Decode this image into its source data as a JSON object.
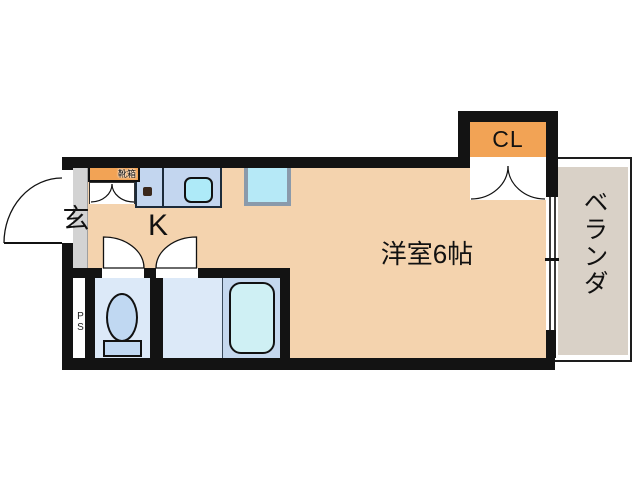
{
  "plan": {
    "rooms": {
      "entrance_label": "玄",
      "kitchen_label": "K",
      "western_room_label": "洋室6帖",
      "closet_label": "CL",
      "veranda_label": "ベランダ",
      "pipe_space_label": "PS",
      "shoe_box_label": "靴箱"
    },
    "colors": {
      "wall": "#131313",
      "room_floor": "#f4d3ae",
      "accent_orange": "#f2a355",
      "entrance_floor": "#d3d3d3",
      "veranda_floor": "#d9d1c7",
      "wet_area_floor": "#dce9f8",
      "bath_section_floor": "#c5d8ee",
      "kitchen_counter": "#c3d6ef",
      "sink": "#aeeaf8",
      "bathtub": "#cff0f4",
      "toilet": "#c0d8f2",
      "washer_space": "#b6e9f7"
    }
  }
}
